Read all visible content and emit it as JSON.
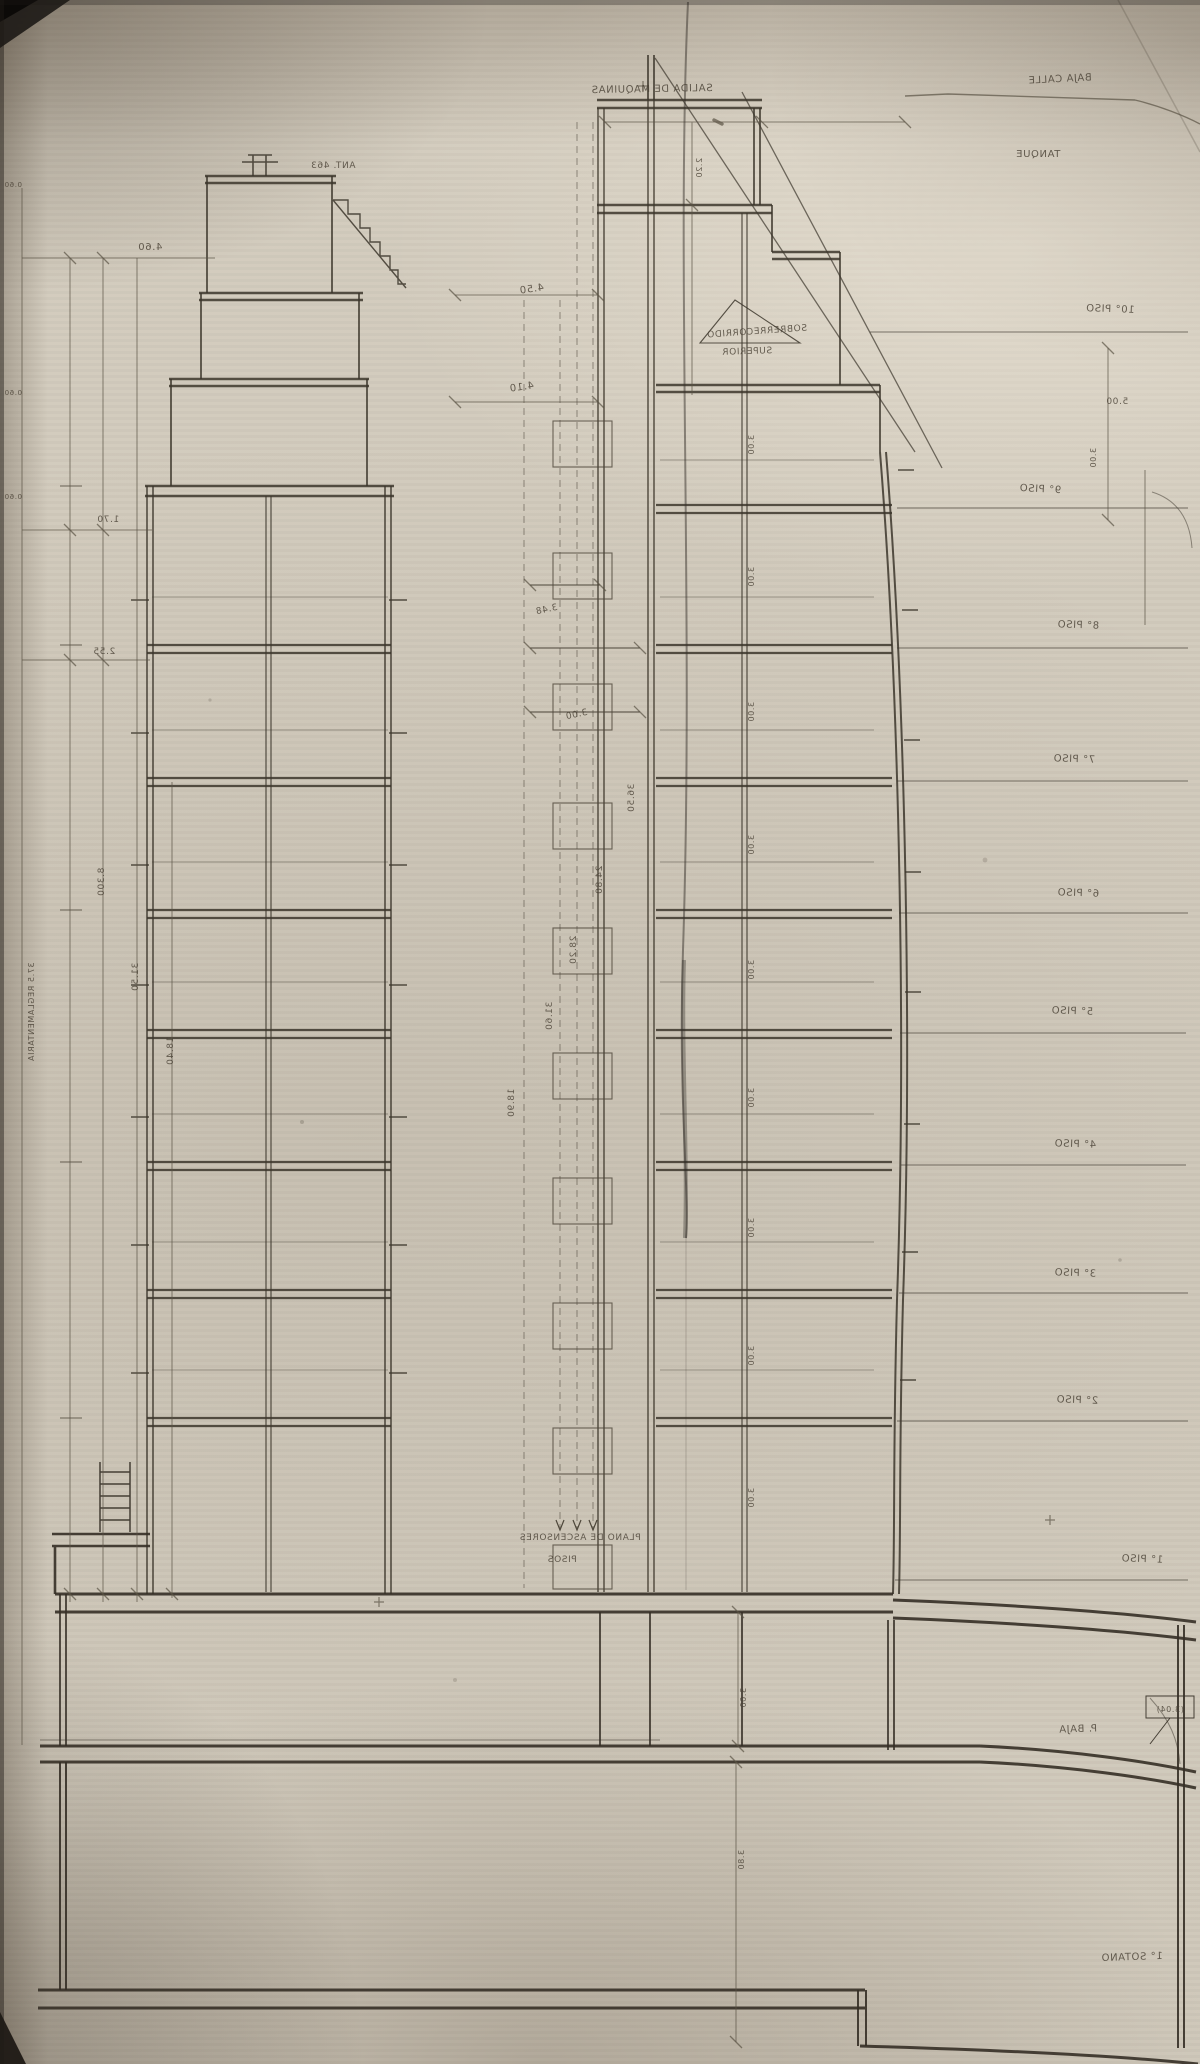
{
  "document": {
    "kind": "scanned hand-drawn architectural cross-section (pencil blueprint)",
    "note": "scan is mirror-reversed; all lettering appears flipped",
    "palette": {
      "paper": "#cfc8ba",
      "line": "#5a5244",
      "line_heavy": "#3a342a",
      "text": "#4a4236"
    }
  },
  "floor_sequence_right_edge": [
    "10° PISO",
    "9° PISO",
    "8° PISO",
    "7° PISO",
    "6° PISO",
    "5° PISO",
    "4° PISO",
    "3° PISO",
    "2° PISO",
    "1° PISO",
    "P. BAJA",
    "1° SOTANO"
  ],
  "annotations": [
    {
      "text": "SALIDA DE MAQUINAS",
      "x": 652,
      "y": 92,
      "size": 10,
      "rot": -1
    },
    {
      "text": "BAJA CALLE",
      "x": 1060,
      "y": 82,
      "size": 10,
      "rot": -3
    },
    {
      "text": "TANQUE",
      "x": 1038,
      "y": 157,
      "size": 10,
      "rot": 0
    },
    {
      "text": "ANT. 463",
      "x": 333,
      "y": 168,
      "size": 9,
      "rot": 0
    },
    {
      "text": "4.60",
      "x": 150,
      "y": 250,
      "size": 10,
      "rot": 0
    },
    {
      "text": "4.50",
      "x": 532,
      "y": 292,
      "size": 10,
      "rot": -8
    },
    {
      "text": "10° PISO",
      "x": 1110,
      "y": 312,
      "size": 10,
      "rot": 2
    },
    {
      "text": "SOBRERRECORRIDO",
      "x": 757,
      "y": 334,
      "size": 9,
      "rot": -4
    },
    {
      "text": "SUPERIOR",
      "x": 747,
      "y": 354,
      "size": 9,
      "rot": -2
    },
    {
      "text": "4.10",
      "x": 522,
      "y": 390,
      "size": 10,
      "rot": -8
    },
    {
      "text": "5.00",
      "x": 1117,
      "y": 404,
      "size": 9,
      "rot": 0
    },
    {
      "text": "2.20",
      "x": 702,
      "y": 168,
      "size": 8,
      "vertical": true
    },
    {
      "text": "9° PISO",
      "x": 1040,
      "y": 492,
      "size": 10,
      "rot": 3
    },
    {
      "text": "1.70",
      "x": 108,
      "y": 522,
      "size": 9,
      "rot": 0
    },
    {
      "text": "3.48",
      "x": 547,
      "y": 612,
      "size": 9,
      "rot": -12
    },
    {
      "text": "8° PISO",
      "x": 1078,
      "y": 628,
      "size": 10,
      "rot": 2
    },
    {
      "text": "2.55",
      "x": 104,
      "y": 654,
      "size": 9,
      "rot": 0
    },
    {
      "text": "3.00",
      "x": 577,
      "y": 717,
      "size": 9,
      "rot": -12
    },
    {
      "text": "7° PISO",
      "x": 1074,
      "y": 762,
      "size": 10,
      "rot": 2
    },
    {
      "text": "6° PISO",
      "x": 1078,
      "y": 896,
      "size": 10,
      "rot": 2
    },
    {
      "text": "5° PISO",
      "x": 1072,
      "y": 1014,
      "size": 10,
      "rot": 2
    },
    {
      "text": "4° PISO",
      "x": 1075,
      "y": 1147,
      "size": 10,
      "rot": 2
    },
    {
      "text": "3° PISO",
      "x": 1075,
      "y": 1276,
      "size": 10,
      "rot": 2
    },
    {
      "text": "2° PISO",
      "x": 1077,
      "y": 1403,
      "size": 10,
      "rot": 2
    },
    {
      "text": "1° PISO",
      "x": 1142,
      "y": 1562,
      "size": 10,
      "rot": 2
    },
    {
      "text": "PLANO DE ASCENSORES",
      "x": 580,
      "y": 1540,
      "size": 9,
      "rot": 0
    },
    {
      "text": "PISOS",
      "x": 562,
      "y": 1562,
      "size": 9,
      "rot": 0
    },
    {
      "text": "(3.04)",
      "x": 1170,
      "y": 1712,
      "size": 8,
      "rot": 0
    },
    {
      "text": "P. BAJA",
      "x": 1078,
      "y": 1732,
      "size": 10,
      "rot": -2
    },
    {
      "text": "1° SOTANO",
      "x": 1132,
      "y": 1960,
      "size": 10,
      "rot": -2
    },
    {
      "text": "0.60",
      "x": 13,
      "y": 187,
      "size": 7,
      "rot": 0
    },
    {
      "text": "0.60",
      "x": 13,
      "y": 395,
      "size": 7,
      "rot": 0
    },
    {
      "text": "0.60",
      "x": 13,
      "y": 499,
      "size": 7,
      "rot": 0
    },
    {
      "text": "8.300",
      "x": 104,
      "y": 882,
      "size": 9,
      "vertical": true
    },
    {
      "text": "31.50",
      "x": 138,
      "y": 977,
      "size": 9,
      "vertical": true
    },
    {
      "text": "18.40",
      "x": 173,
      "y": 1051,
      "size": 9,
      "vertical": true
    },
    {
      "text": "37.5 REGLAMENTARIA",
      "x": 34,
      "y": 1012,
      "size": 8,
      "vertical": true
    },
    {
      "text": "36.50",
      "x": 634,
      "y": 798,
      "size": 9,
      "vertical": true
    },
    {
      "text": "24.80",
      "x": 602,
      "y": 880,
      "size": 9,
      "vertical": true
    },
    {
      "text": "28.20",
      "x": 576,
      "y": 950,
      "size": 9,
      "vertical": true
    },
    {
      "text": "31.60",
      "x": 552,
      "y": 1016,
      "size": 9,
      "vertical": true
    },
    {
      "text": "18.90",
      "x": 514,
      "y": 1103,
      "size": 9,
      "vertical": true
    },
    {
      "text": "3.00",
      "x": 754,
      "y": 445,
      "size": 8,
      "vertical": true
    },
    {
      "text": "3.00",
      "x": 754,
      "y": 577,
      "size": 8,
      "vertical": true
    },
    {
      "text": "3.00",
      "x": 754,
      "y": 712,
      "size": 8,
      "vertical": true
    },
    {
      "text": "3.00",
      "x": 754,
      "y": 845,
      "size": 8,
      "vertical": true
    },
    {
      "text": "3.00",
      "x": 754,
      "y": 970,
      "size": 8,
      "vertical": true
    },
    {
      "text": "3.00",
      "x": 754,
      "y": 1098,
      "size": 8,
      "vertical": true
    },
    {
      "text": "3.00",
      "x": 754,
      "y": 1228,
      "size": 8,
      "vertical": true
    },
    {
      "text": "3.00",
      "x": 754,
      "y": 1356,
      "size": 8,
      "vertical": true
    },
    {
      "text": "3.00",
      "x": 754,
      "y": 1498,
      "size": 8,
      "vertical": true
    },
    {
      "text": "3.00",
      "x": 1096,
      "y": 458,
      "size": 8,
      "vertical": true
    },
    {
      "text": "3.00",
      "x": 746,
      "y": 1698,
      "size": 8,
      "vertical": true
    },
    {
      "text": "3.80",
      "x": 744,
      "y": 1860,
      "size": 8,
      "vertical": true
    }
  ]
}
